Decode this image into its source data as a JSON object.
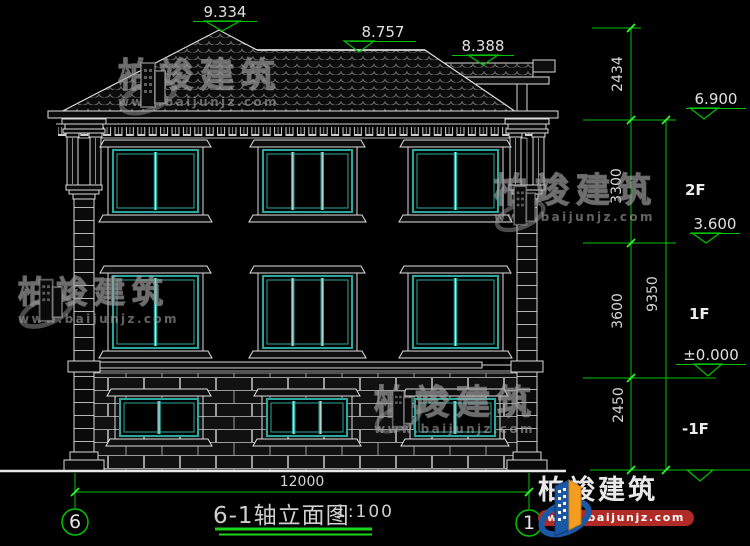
{
  "drawing": {
    "title": "6-1轴立面图",
    "scale": "1:100",
    "levels": {
      "peak": "9.334",
      "ridge": "8.757",
      "porch_roof": "8.388",
      "eave": "6.900",
      "floor2": "3.600",
      "floor1": "±0.000"
    },
    "floor_labels": {
      "f2": "2F",
      "f1": "1F",
      "b1": "-1F"
    },
    "dims": {
      "roof_height": "2434",
      "floor2_height": "3300",
      "floor1_height": "3600",
      "basement_height": "2450",
      "total_height": "9350",
      "total_width": "12000"
    },
    "axes": {
      "left": "6",
      "right": "1"
    }
  },
  "watermark": {
    "brand": "柏竣建筑",
    "url": "www.baijunjz.com"
  },
  "logo": {
    "brand": "柏竣建筑",
    "url": "www.baijunjz.com"
  },
  "colors": {
    "background": "#000000",
    "dimension_green": "#00c400",
    "window_teal": "#2ba79d",
    "line_white": "#d9d9d9",
    "logo_blue": "#1a57a5",
    "logo_orange": "#f59d1e",
    "logo_red": "#b02a26"
  }
}
